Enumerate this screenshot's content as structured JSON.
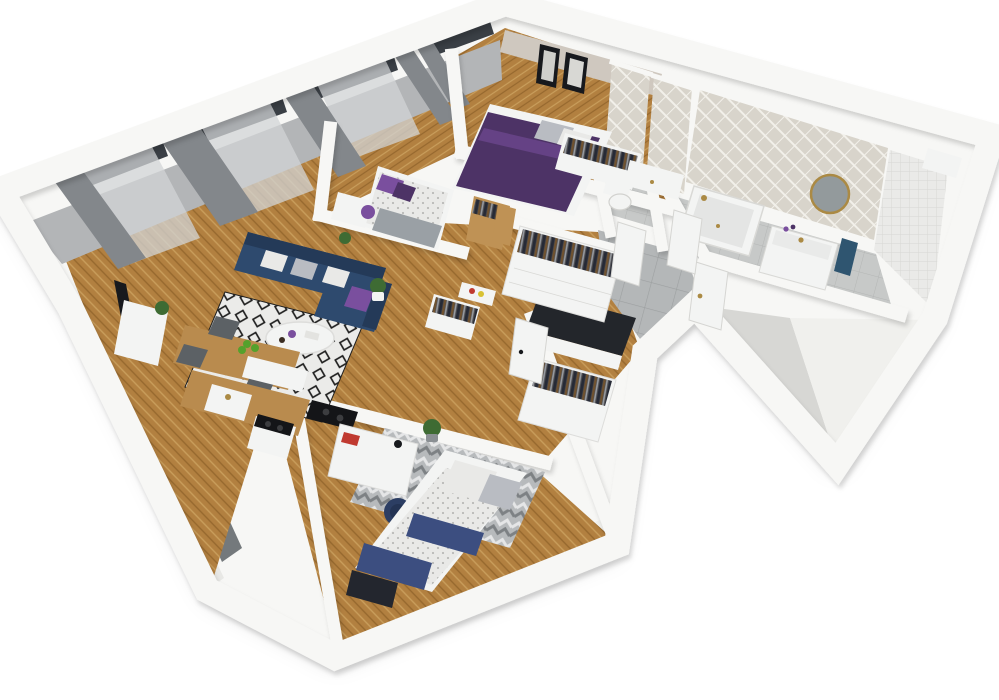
{
  "meta": {
    "title": "3D isometric cutaway rendering of a three-bedroom apartment floor plan",
    "view": "axonometric bird's-eye cutaway, no text or UI chrome visible"
  },
  "colors": {
    "background": "#ffffff",
    "wall_top": "#f7f7f5",
    "wall_edge": "#d9d9d6",
    "wall_face": "#b3b5b7",
    "wall_face_light": "#ededea",
    "wall_face_dark": "#5d6366",
    "beige_wall": "#cfc8bf",
    "floor_wood": "#b28040",
    "floor_wood_light": "#c99e5c",
    "floor_wood_dark": "#96682e",
    "tile_floor": "#b4b7b8",
    "tile_line": "#9da0a1",
    "bath_tile": "#c7c9c8",
    "bath_tile_line": "#b4b6b5",
    "rug_base": "#ebebe9",
    "rug_diamond": "#1f1f1f",
    "chevron_base": "#b7babc",
    "chevron_light": "#e5e6e7",
    "chevron_dark": "#7d8184",
    "herringbone_tile": "#d8d4cb",
    "herringbone_line": "#f2f0ea",
    "mosaic_tile": "#eaeae8",
    "mosaic_line": "#d6d6d3",
    "sofa_navy": "#2e4a6e",
    "sofa_navy_dark": "#243a58",
    "pillow_white": "#e9e9e7",
    "pillow_gray": "#b9bcc2",
    "accent_purple": "#7a4f9e",
    "bedding_purple": "#4d3366",
    "bedding_navy": "#3c4e80",
    "quilt_dark": "#23262e",
    "duvet_white": "#e9e9e7",
    "duvet_dot": "#b9b9b7",
    "blanket_gray": "#9aa0a5",
    "curtain_gray": "#83878b",
    "curtain_sheer": "#d2d4d6",
    "window_glass": "#3a3f45",
    "wood_furniture": "#b98b4e",
    "wood_door": "#bf9255",
    "metal_gold": "#ab8a44",
    "tv_black": "#17191d",
    "plant_green": "#3e6b33",
    "apple_green": "#55a12c",
    "chair_gray": "#5c6165",
    "office_chair_navy": "#2c3e63",
    "ceramic_white": "#f3f4f3",
    "mirror_glass": "#939a9c",
    "towel_blue": "#2f5570",
    "book_red": "#c03a30",
    "box_yellow": "#d8c233",
    "cooktop_black": "#141518",
    "counter_unit_top": "#23262b",
    "clothes_dark": "#262a36",
    "clothes_brown": "#70522f",
    "clothes_gray": "#9a9da2",
    "clothes_rail": "#4a4a4e"
  },
  "rooms": [
    {
      "id": "living-room",
      "name": "Living room",
      "furniture": [
        "navy corner sofa",
        "white and gray cushions",
        "purple accent cushion",
        "round white coffee table",
        "purple vase",
        "black-and-white diamond rug",
        "wall TV",
        "white media cabinet",
        "potted plants",
        "gray drapes",
        "sheer curtains",
        "two tall windows"
      ]
    },
    {
      "id": "kitchen-dining",
      "name": "Kitchen and dining area",
      "furniture": [
        "wooden dining table",
        "bowl of green apples",
        "gray chairs",
        "wood worktop with sink",
        "gold faucet",
        "freestanding cooker",
        "black cooktop",
        "white cabinets",
        "tall unit with dark top"
      ]
    },
    {
      "id": "bedroom-small",
      "name": "Small bedroom",
      "furniture": [
        "single bed",
        "purple pillows",
        "gray blanket",
        "white console desk",
        "purple chair",
        "window with gray curtains",
        "potted plant"
      ]
    },
    {
      "id": "bedroom-master",
      "name": "Master bedroom",
      "furniture": [
        "double bed with purple duvet",
        "gray pillows",
        "two black-framed wall artworks",
        "white wardrobe with hanging clothes",
        "wooden open wardrobe",
        "white bedside unit",
        "window with gray curtains"
      ]
    },
    {
      "id": "hallway",
      "name": "Hallway",
      "furniture": [
        "white wardrobe bank with hanging clothes",
        "small open wardrobe",
        "shelf with boxes",
        "white entrance door",
        "gray tile floor",
        "hall cabinet"
      ]
    },
    {
      "id": "wc",
      "name": "WC",
      "furniture": [
        "toilet",
        "herringbone tiled walls",
        "white door"
      ]
    },
    {
      "id": "bathroom",
      "name": "Bathroom",
      "furniture": [
        "bathtub with gold shower fittings",
        "white vanity with basin",
        "gold round mirror",
        "blue towel",
        "herringbone tile wall",
        "white mosaic wall",
        "white door",
        "wall niche"
      ]
    },
    {
      "id": "kids-bedroom",
      "name": "Kids bedroom",
      "furniture": [
        "single bed with white patterned duvet",
        "navy quilted blanket",
        "dotted and striped pillows",
        "white desk with books",
        "navy office chair",
        "gray chevron rug",
        "open wardrobe with clothes",
        "potted plant",
        "white door"
      ]
    }
  ]
}
